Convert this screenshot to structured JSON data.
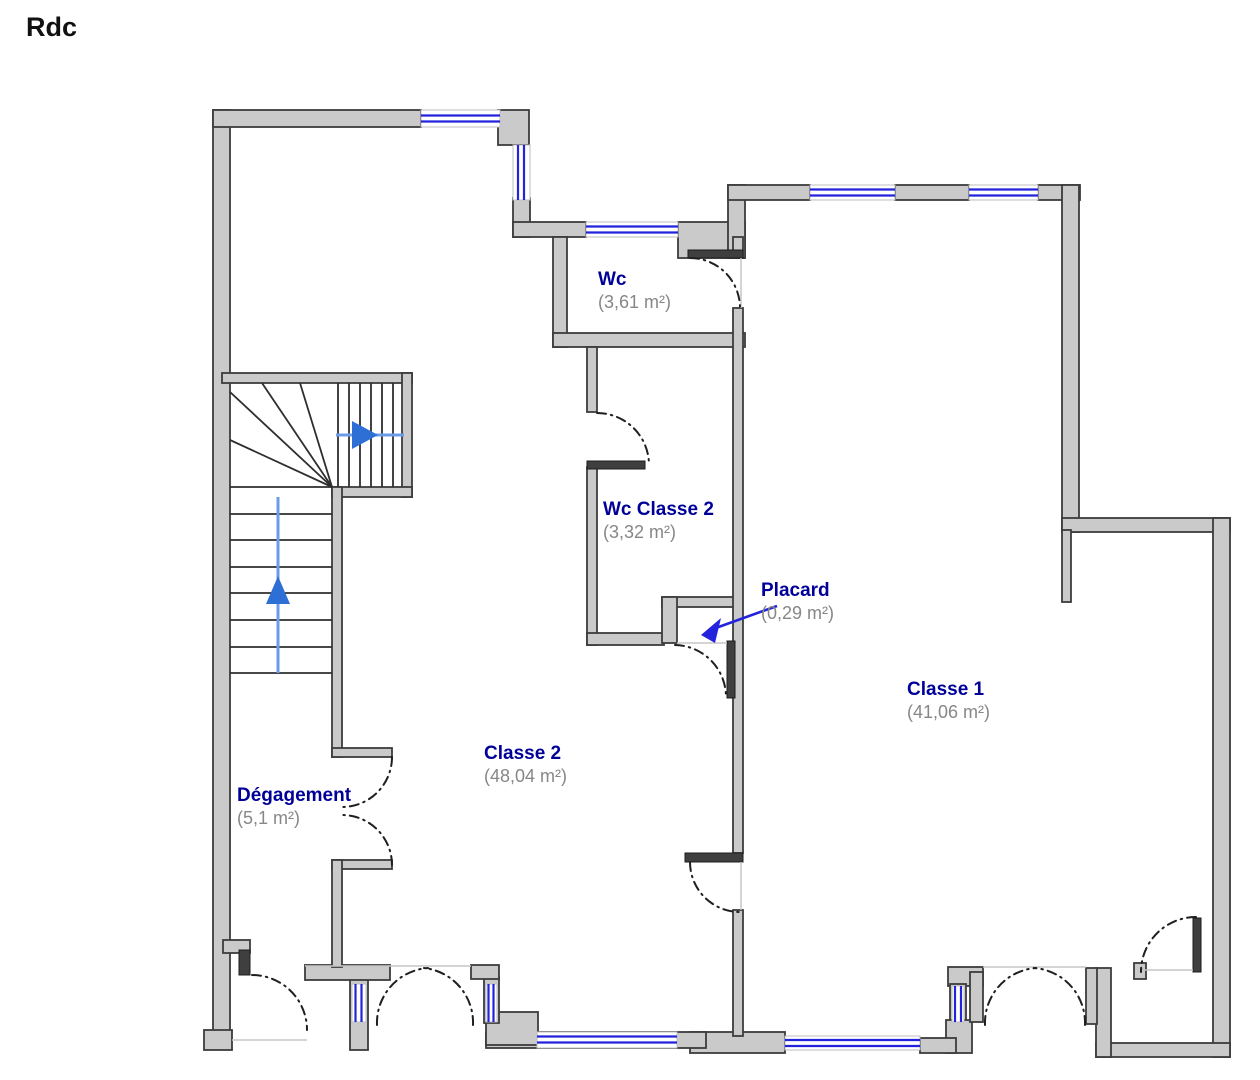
{
  "title": "Rdc",
  "colors": {
    "wall_fill": "#cacaca",
    "wall_stroke": "#3c3c3c",
    "window_blue": "#2323dd",
    "label_navy": "#000099",
    "area_gray": "#878787",
    "stair_arrow_line": "#6b9ce8",
    "stair_arrow_head": "#2e6fd6",
    "door_arc": "#1f1f1f",
    "leaf_dark": "#3f3f3f"
  },
  "rooms": {
    "wc": {
      "name": "Wc",
      "area": "(3,61 m²)"
    },
    "wc_classe2": {
      "name": "Wc Classe 2",
      "area": "(3,32 m²)"
    },
    "placard": {
      "name": "Placard",
      "area": "(0,29 m²)"
    },
    "classe1": {
      "name": "Classe 1",
      "area": "(41,06 m²)"
    },
    "classe2": {
      "name": "Classe 2",
      "area": "(48,04 m²)"
    },
    "degagement": {
      "name": "Dégagement",
      "area": "(5,1 m²)"
    }
  }
}
